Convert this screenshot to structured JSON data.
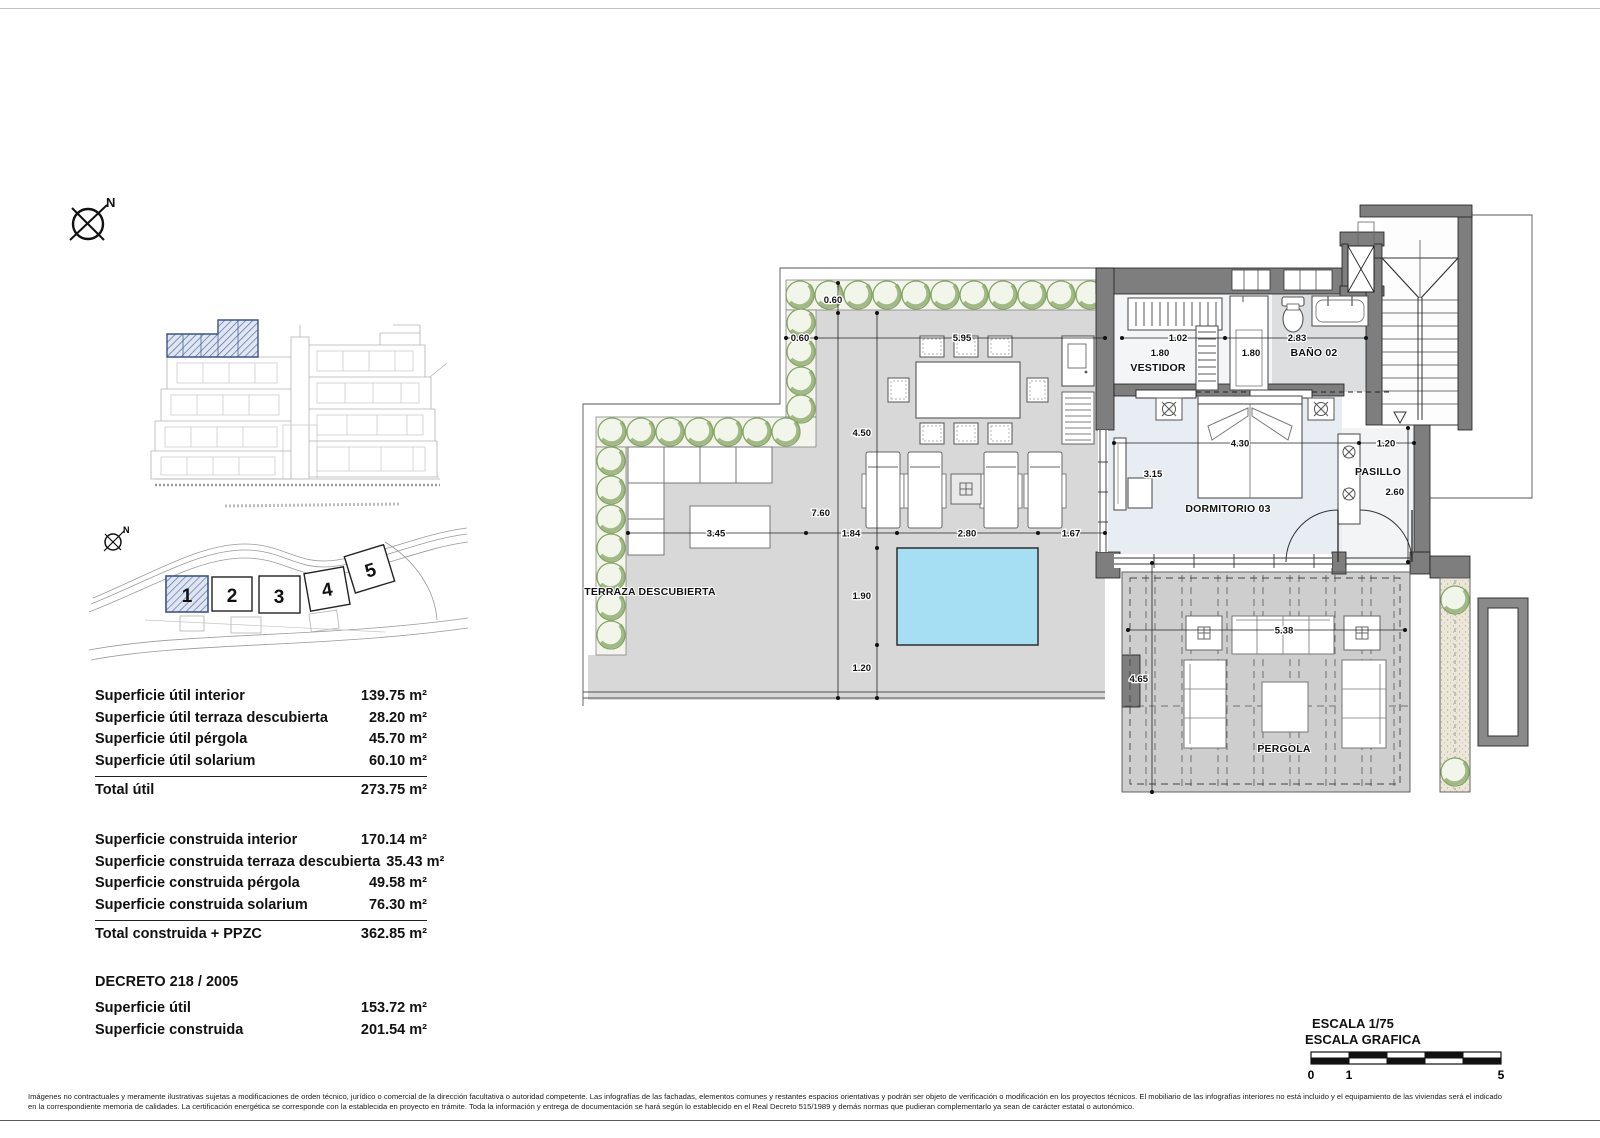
{
  "compass": {
    "label": "N"
  },
  "site_plan": {
    "north_label": "N",
    "blocks": [
      "1",
      "2",
      "3",
      "4",
      "5"
    ]
  },
  "tables": {
    "useful": {
      "rows": [
        {
          "label": "Superficie útil interior",
          "value": "139.75 m²"
        },
        {
          "label": "Superficie útil terraza descubierta",
          "value": "28.20 m²"
        },
        {
          "label": "Superficie útil pérgola",
          "value": "45.70 m²"
        },
        {
          "label": "Superficie útil solarium",
          "value": "60.10 m²"
        }
      ],
      "total_label": "Total útil",
      "total_value": "273.75 m²"
    },
    "built": {
      "rows": [
        {
          "label": "Superficie construida interior",
          "value": "170.14 m²"
        },
        {
          "label": "Superficie construida terraza descubierta",
          "value": "35.43 m²"
        },
        {
          "label": "Superficie construida pérgola",
          "value": "49.58 m²"
        },
        {
          "label": "Superficie construida solarium",
          "value": "76.30 m²"
        }
      ],
      "total_label": "Total construida + PPZC",
      "total_value": "362.85 m²"
    },
    "decreto": {
      "title": "DECRETO 218 / 2005",
      "rows": [
        {
          "label": "Superficie útil",
          "value": "153.72 m²"
        },
        {
          "label": "Superficie construida",
          "value": "201.54 m²"
        }
      ]
    }
  },
  "plan": {
    "rooms": {
      "terraza": "TERRAZA DESCUBIERTA",
      "dormitorio": "DORMITORIO 03",
      "bano": "BAÑO 02",
      "vestidor": "VESTIDOR",
      "pasillo": "PASILLO",
      "pergola": "PERGOLA"
    },
    "dims": {
      "d060_top": "0.60",
      "d060_left": "0.60",
      "d595": "5.95",
      "d450": "4.50",
      "d760": "7.60",
      "d345": "3.45",
      "d184": "1.84",
      "d280": "2.80",
      "d167": "1.67",
      "d190": "1.90",
      "d120_pool": "1.20",
      "d102": "1.02",
      "d180_vestidor": "1.80",
      "d180_shower": "1.80",
      "d283": "2.83",
      "d430": "4.30",
      "d315": "3.15",
      "d120_pasillo": "1.20",
      "d260": "2.60",
      "d465": "4.65",
      "d538": "5.38"
    }
  },
  "scale_block": {
    "line1": "ESCALA 1/75",
    "line2": "ESCALA GRAFICA",
    "tick0": "0",
    "tick1": "1",
    "tick5": "5"
  },
  "disclaimer": {
    "line1": "Imágenes no contractuales y meramente ilustrativas sujetas a modificaciones de orden técnico, jurídico o comercial de la dirección facultativa o autoridad competente. Las infografías de las fachadas, elementos comunes y restantes espacios orientativas y podrán ser objeto de verificación o modificación en los proyectos técnicos. El mobiliario de las infografías interiores no está incluido y el equipamiento de las viviendas será el indicado",
    "line2": "en la correspondiente memoria de calidades. La certificación energética se corresponde con la establecida en proyecto en trámite. Toda la información y entrega de documentación se hará según lo establecido en el Real Decreto 515/1989 y demás normas que pudieran complementarlo ya sean de carácter estatal o autonómico."
  },
  "colors": {
    "pool": "#a6def4",
    "highlight_blue": "#5b74a8",
    "wall_gray": "#7e7e7e",
    "plant_green": "#86a563"
  }
}
